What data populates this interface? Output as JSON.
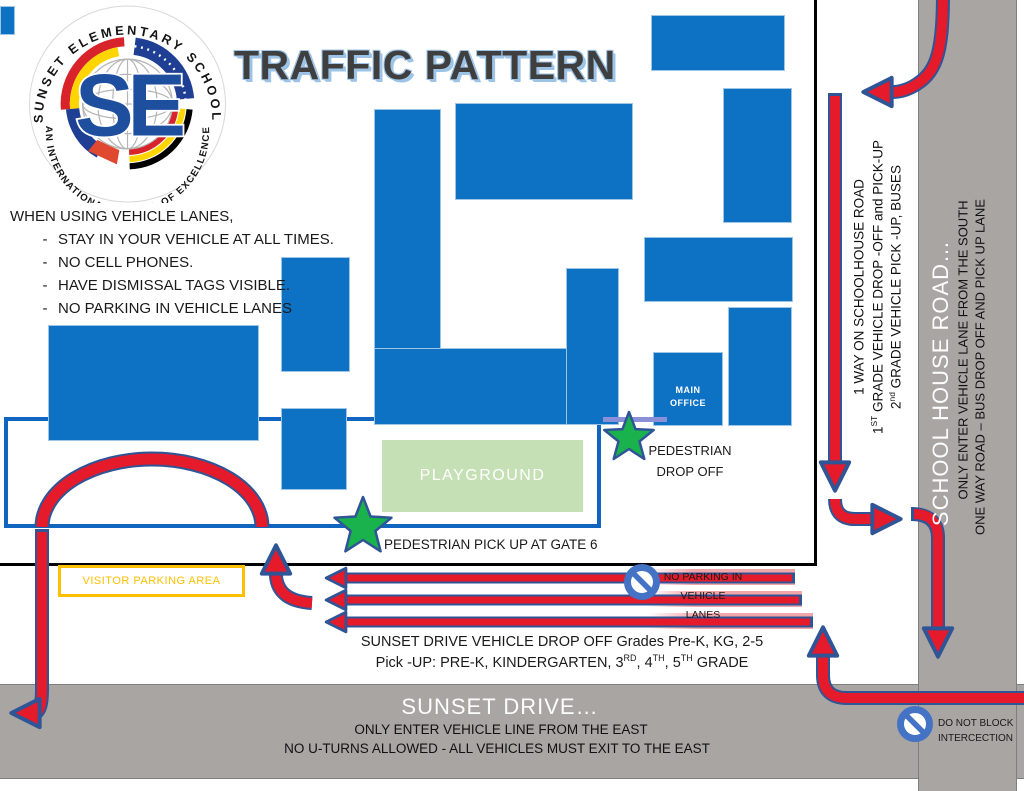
{
  "title": "TRAFFIC PATTERN",
  "logo": {
    "arc_top": "SUNSET ELEMENTARY SCHOOL",
    "arc_bottom": "AN INTERNATIONAL SCHOOL OF EXCELLENCE",
    "monogram": "SE"
  },
  "rules": {
    "heading": "WHEN USING VEHICLE LANES,",
    "bullet": "-",
    "items": [
      "STAY IN YOUR VEHICLE AT ALL TIMES.",
      "NO CELL PHONES.",
      "HAVE DISMISSAL TAGS VISIBLE.",
      "NO PARKING IN VEHICLE LANES"
    ]
  },
  "campus": {
    "playground_label": "PLAYGROUND",
    "main_office_label": "MAIN OFFICE",
    "pedestrian_drop_off": "PEDESTRIAN DROP OFF",
    "pedestrian_pick_up": "PEDESTRIAN PICK UP AT GATE 6",
    "visitor_parking": "VISITOR PARKING AREA"
  },
  "lanes": {
    "no_parking_sign": "NO PARKING IN VEHICLE LANES",
    "drop_off_note": "SUNSET DRIVE VEHICLE DROP OFF Grades Pre-K, KG, 2-5",
    "pick_up_note_segments": [
      {
        "t": "Pick -UP: PRE-K, KINDERGARTEN, 3"
      },
      {
        "t": "RD",
        "sup": true
      },
      {
        "t": ", 4"
      },
      {
        "t": "TH",
        "sup": true
      },
      {
        "t": ", 5"
      },
      {
        "t": "TH",
        "sup": true
      },
      {
        "t": " GRADE"
      }
    ]
  },
  "sunset_drive": {
    "name": "SUNSET DRIVE…",
    "note1": "ONLY ENTER VEHICLE LINE FROM THE EAST",
    "note2": "NO U-TURNS ALLOWED - ALL VEHICLES MUST EXIT TO THE EAST",
    "do_not_block": "DO NOT BLOCK INTERCECTION"
  },
  "school_house_road": {
    "name": "SCHOOL HOUSE ROAD…",
    "on_road_note1": "ONLY ENTER VEHICLE LANE FROM THE SOUTH",
    "on_road_note2": "ONE WAY ROAD – BUS DROP OFF AND PICK UP LANE",
    "side_note1": "1 WAY ON SCHOOLHOUSE ROAD",
    "side_note2_segments": [
      {
        "t": "1"
      },
      {
        "t": "ST",
        "sup": true
      },
      {
        "t": " GRADE VEHICLE DROP -OFF and PICK-UP"
      }
    ],
    "side_note3_segments": [
      {
        "t": "2"
      },
      {
        "t": "nd",
        "sup": true
      },
      {
        "t": " GRADE VEHICLE PICK -UP, BUSES"
      }
    ]
  },
  "colors": {
    "building_blue": "#0d72c4",
    "fence_blue": "#1065c0",
    "route_red": "#e51a2b",
    "route_outline": "#2f5597",
    "road_gray": "#a8a5a2",
    "playground_green": "#c5e0b4",
    "star_green": "#19b24c",
    "visitor_yellow": "#ffc000",
    "sign_blue": "#4472c4",
    "title_shadow_blue": "#9dc3e6"
  }
}
